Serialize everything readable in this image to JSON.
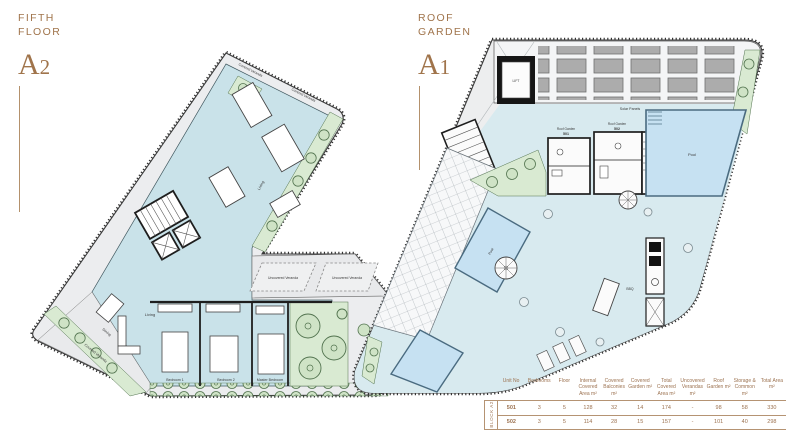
{
  "titles": {
    "a2": {
      "line1": "FIFTH",
      "line2": "FLOOR",
      "code_letter": "A",
      "code_digit": "2"
    },
    "a1": {
      "line1": "ROOF",
      "line2": "GARDEN",
      "code_letter": "A",
      "code_digit": "1"
    }
  },
  "plan_a2": {
    "labels": {
      "covered_veranda": "Covered Veranda",
      "uncovered_veranda": "Uncovered Veranda",
      "living": "Living",
      "dining": "Dining",
      "bedroom_1": "Bedroom 1",
      "bedroom_2": "Bedroom 2",
      "master_bedroom": "Master Bedroom"
    }
  },
  "plan_a1": {
    "labels": {
      "lift": "LIFT",
      "solar_panels": "Solar Panels",
      "roof_garden": "Roof Garden",
      "unit_501": "501",
      "unit_502": "502",
      "pool": "Pool",
      "bbq": "BBQ"
    }
  },
  "table": {
    "block_label": "BLOCK A2",
    "columns": [
      "Unit No",
      "Bedrooms",
      "Floor",
      "Internal Covered Area m²",
      "Covered Balconies m²",
      "Covered Garden m²",
      "Total Covered Area m²",
      "Uncovered Verandas m²",
      "Roof Garden m²",
      "Storage & Common m²",
      "Total Area m²"
    ],
    "rows": [
      {
        "unit_no": "501",
        "bedrooms": "3",
        "floor": "5",
        "internal_covered": "128",
        "covered_balconies": "32",
        "covered_garden": "14",
        "total_covered": "174",
        "uncovered_verandas": "-",
        "roof_garden": "98",
        "storage_common": "58",
        "total_area": "330"
      },
      {
        "unit_no": "502",
        "bedrooms": "3",
        "floor": "5",
        "internal_covered": "114",
        "covered_balconies": "28",
        "covered_garden": "15",
        "total_covered": "157",
        "uncovered_verandas": "-",
        "roof_garden": "101",
        "storage_common": "40",
        "total_area": "298"
      }
    ]
  },
  "colors": {
    "accent_brown": "#A0744B",
    "room_blue": "#C9E2E9",
    "deck_blue": "#D8EAEF",
    "pool_blue": "#C6E1F2",
    "garden_green": "#D9EAD2",
    "veranda_gray": "#ECEDEF",
    "wall_black": "#1E1E1E"
  }
}
